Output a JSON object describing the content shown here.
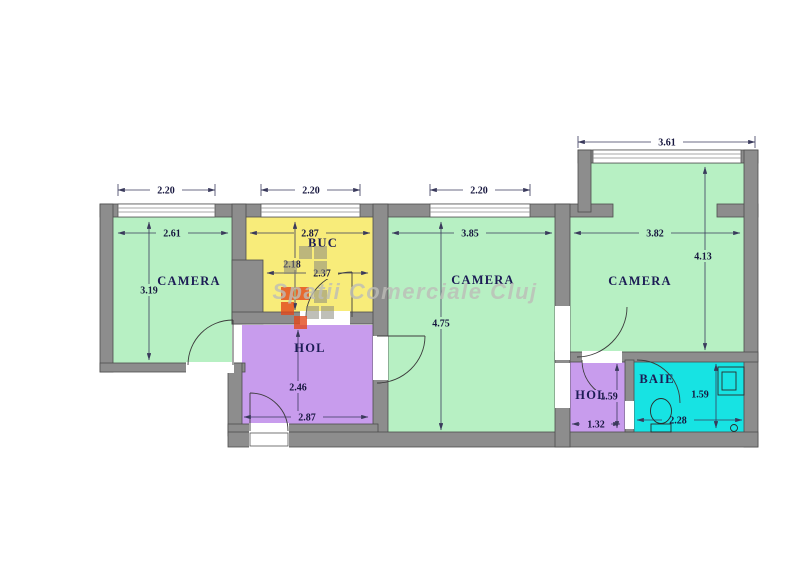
{
  "watermark": {
    "text": "Spatii Comerciale Cluj"
  },
  "rooms": {
    "camera_left": {
      "label": "CAMERA"
    },
    "buc": {
      "label": "BUC"
    },
    "camera_middle": {
      "label": "CAMERA"
    },
    "camera_right": {
      "label": "CAMERA"
    },
    "hol_main": {
      "label": "HOL"
    },
    "hol_small": {
      "label": "HOL"
    },
    "baie": {
      "label": "BAIE"
    }
  },
  "dimensions": {
    "window_left": "2.20",
    "window_buc": "2.20",
    "window_middle": "2.20",
    "window_bay": "3.61",
    "camera_left_width": "2.61",
    "camera_left_height": "3.19",
    "buc_width": "2.87",
    "buc_height": "2.18",
    "buc_lower_width": "2.37",
    "camera_middle_width": "3.85",
    "camera_middle_height": "4.75",
    "camera_right_width": "3.82",
    "camera_right_height": "4.13",
    "hol_main_height": "2.46",
    "hol_main_width": "2.87",
    "hol_small_height": "1.59",
    "hol_small_width": "1.32",
    "baie_height": "1.59",
    "baie_width": "2.28"
  },
  "colors": {
    "room_green": "#b7f0c3",
    "room_yellow": "#f8ec7a",
    "room_purple": "#c89ced",
    "room_cyan": "#17e3e3",
    "wall_gray": "#8d8d8d",
    "label_navy": "#1c1c55",
    "watermark_gray": "#bdbdb8",
    "logo_red": "#e2491c"
  }
}
